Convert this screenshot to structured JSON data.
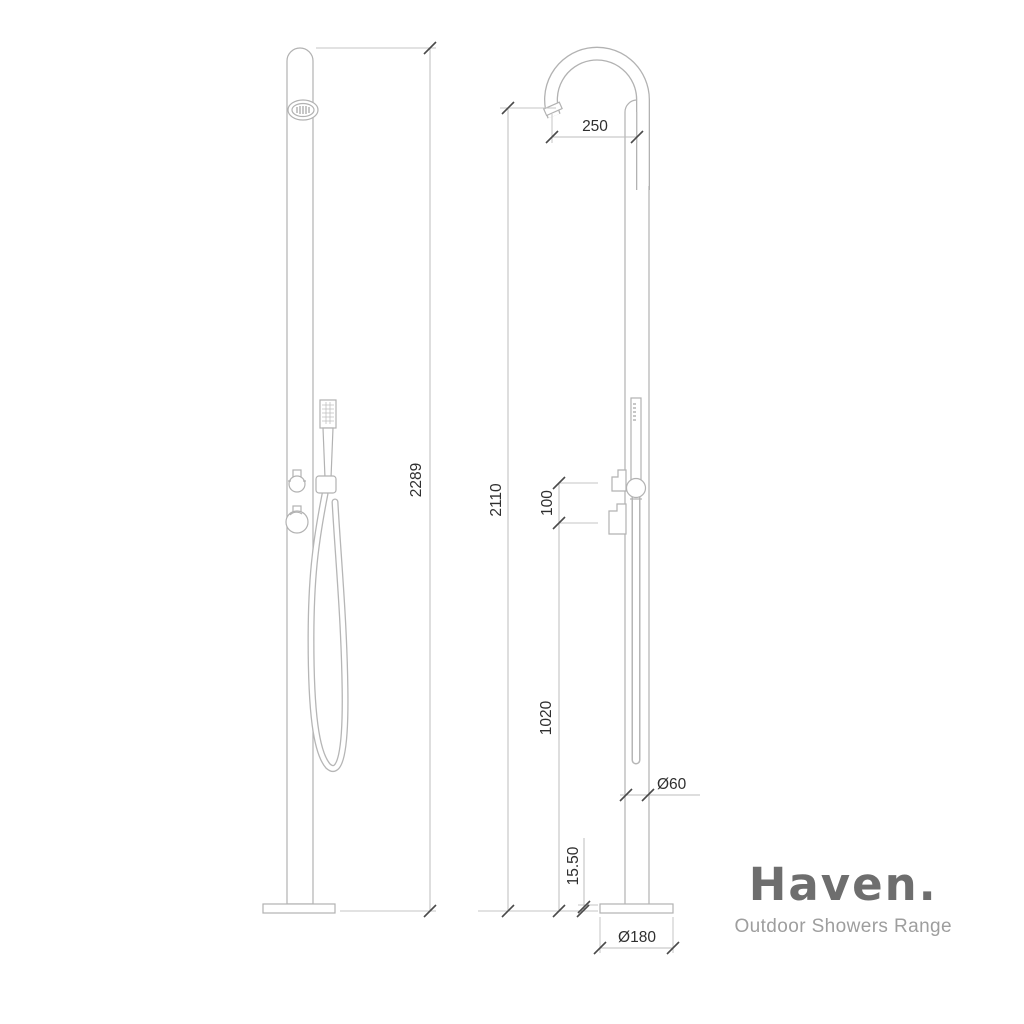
{
  "page": {
    "background_color": "#ffffff",
    "line_color": "#b2b2b2",
    "dimension_text_color": "#2f2f2f"
  },
  "drawing": {
    "type": "technical-dimension-drawing",
    "subject": "freestanding outdoor shower column, front and side elevations",
    "dimensions": {
      "front_total_height": "2289",
      "spout_reach": "250",
      "side_overall_height": "2110",
      "control_spacing": "100",
      "lower_section_height": "1020",
      "column_diameter": "Ø60",
      "base_plate_thickness": "15.50",
      "base_plate_diameter": "Ø180"
    }
  },
  "brand": {
    "name": "Haven.",
    "tagline": "Outdoor Showers Range",
    "name_color": "#6e6e6e",
    "tagline_color": "#9e9e9e"
  }
}
